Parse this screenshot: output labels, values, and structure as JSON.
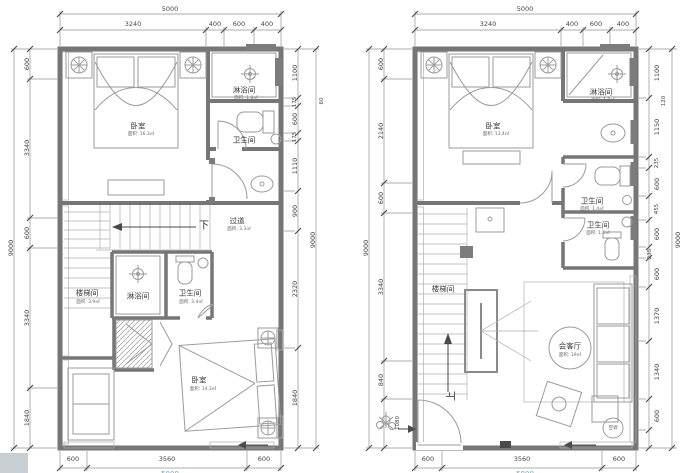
{
  "drawing": {
    "type": "architectural floor plans, duplex apartment, two levels side by side",
    "line_color": "#8a8a8a",
    "wall_color": "#767676",
    "accent_cyan": "#62aec2"
  },
  "plans": [
    {
      "name": "upper-level-plan",
      "dims": {
        "top_total": "5000",
        "top": [
          "3240",
          "400",
          "600",
          "400"
        ],
        "left_total": "9000",
        "left": [
          "600",
          "3340",
          "600",
          "3340",
          "1840"
        ],
        "right": [
          "1100",
          "175",
          "600",
          "175",
          "1110",
          "900",
          "2320",
          "1840"
        ],
        "right_outer_small": "60",
        "right_total": "9000",
        "bottom": [
          "600",
          "3560",
          "600"
        ],
        "bottom_total": "5000"
      },
      "labels": {
        "bedroom_top": "卧室",
        "bedroom_top_area": "面积: 16.3㎡",
        "shower_top": "淋浴间",
        "shower_top_area": "面积: 1.8㎡",
        "toilet_top": "卫生间",
        "down": "下",
        "corridor": "过道",
        "corridor_area": "面积: 3.3㎡",
        "stairwell": "楼梯间",
        "stairwell_area": "面积: 3.9㎡",
        "shower_mid": "淋浴间",
        "toilet_mid": "卫生间",
        "toilet_mid_area": "面积: 3.4㎡",
        "bedroom_bottom": "卧室",
        "bedroom_bottom_area": "面积: 14.3㎡"
      }
    },
    {
      "name": "lower-level-plan",
      "dims": {
        "top_total": "5000",
        "top": [
          "3240",
          "400",
          "600",
          "400"
        ],
        "left_total": "9000",
        "left": [
          "600",
          "2140",
          "600",
          "3340",
          "840"
        ],
        "left_small": "1080",
        "right": [
          "1100",
          "1150",
          "235",
          "600",
          "455",
          "600",
          "235",
          "600",
          "1370",
          "1340",
          "600"
        ],
        "right_outer_small": "120",
        "right_total": "9000",
        "bottom": [
          "600",
          "3560",
          "600"
        ],
        "bottom_total": "5000"
      },
      "labels": {
        "bedroom_top": "卧室",
        "bedroom_top_area": "面积: 13.4㎡",
        "shower_top": "淋浴间",
        "shower_top_area": "面积: 1.8㎡",
        "toilet_upper": "卫生间",
        "toilet_upper_area": "面积: 1.4㎡",
        "toilet_lower": "卫生间",
        "toilet_lower_area": "面积: 1.5㎡",
        "stairwell": "楼梯间",
        "living": "会客厅",
        "living_area": "面积: 19㎡",
        "up": "上",
        "ac": "空调"
      }
    }
  ]
}
